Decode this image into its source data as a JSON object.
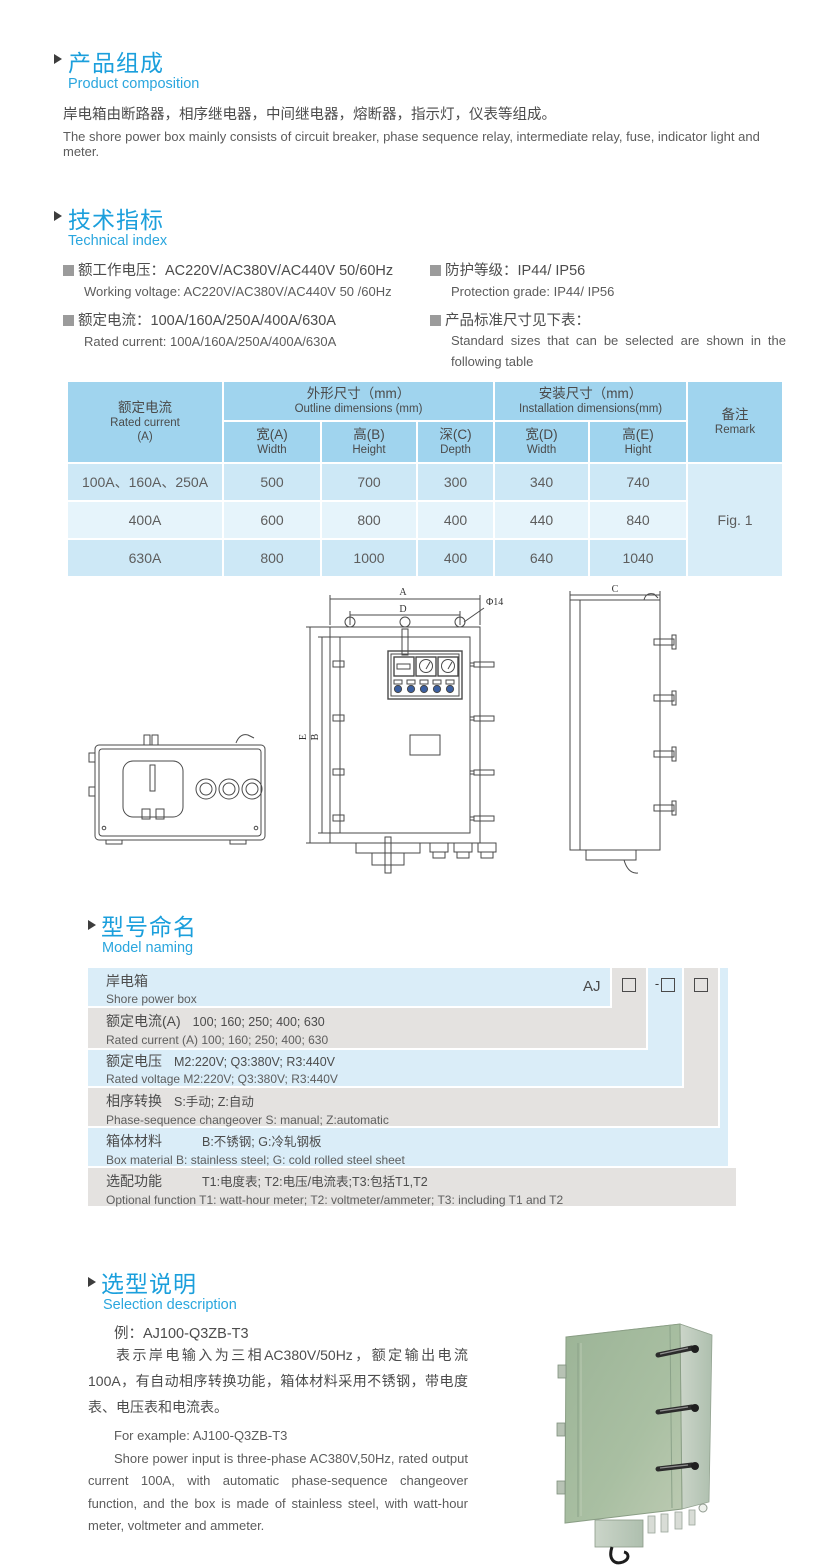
{
  "colors": {
    "accent_blue": "#1b9fdc",
    "subheading_blue": "#2aa6de",
    "table_header_bg": "#a0d4ee",
    "table_row_dark": "#cde8f6",
    "table_row_light": "#e6f4fb",
    "remark_cell_bg": "#d8edf8",
    "naming_blue": "#daedf8",
    "naming_gray": "#e4e2e0",
    "photo_green_front": "#a6bca0",
    "photo_green_side": "#c2cdc0"
  },
  "product_composition": {
    "title_cn": "产品组成",
    "title_en": "Product  composition",
    "body_cn": "岸电箱由断路器，相序继电器，中间继电器，熔断器，指示灯，仪表等组成。",
    "body_en": "The shore power box mainly consists of circuit breaker, phase sequence relay, intermediate relay, fuse, indicator light and meter."
  },
  "technical_index": {
    "title_cn": "技术指标",
    "title_en": "Technical index",
    "specs": [
      {
        "cn": "额工作电压：AC220V/AC380V/AC440V  50/60Hz",
        "en": "Working voltage: AC220V/AC380V/AC440V 50 /60Hz"
      },
      {
        "cn": "额定电流：100A/160A/250A/400A/630A",
        "en": "Rated current: 100A/160A/250A/400A/630A"
      },
      {
        "cn": "防护等级：IP44/ IP56",
        "en": "Protection grade: IP44/ IP56"
      },
      {
        "cn": "产品标准尺寸见下表：",
        "en": "Standard sizes that can be selected are shown in the following table"
      }
    ]
  },
  "size_table": {
    "header": {
      "current_cn": "额定电流",
      "current_en": "Rated current",
      "current_unit": "(A)",
      "outline_cn": "外形尺寸（mm）",
      "outline_en": "Outline dimensions (mm)",
      "install_cn": "安装尺寸（mm）",
      "install_en": "Installation dimensions(mm)",
      "remark_cn": "备注",
      "remark_en": "Remark",
      "sub": [
        {
          "cn": "宽(A)",
          "en": "Width"
        },
        {
          "cn": "高(B)",
          "en": "Height"
        },
        {
          "cn": "深(C)",
          "en": "Depth"
        },
        {
          "cn": "宽(D)",
          "en": "Width"
        },
        {
          "cn": "高(E)",
          "en": "Hight"
        }
      ]
    },
    "rows": [
      {
        "current": "100A、160A、250A",
        "w": "500",
        "h": "700",
        "d": "300",
        "iw": "340",
        "ih": "740"
      },
      {
        "current": "400A",
        "w": "600",
        "h": "800",
        "d": "400",
        "iw": "440",
        "ih": "840"
      },
      {
        "current": "630A",
        "w": "800",
        "h": "1000",
        "d": "400",
        "iw": "640",
        "ih": "1040"
      }
    ],
    "remark_value": "Fig. 1"
  },
  "drawing": {
    "dim_a": "A",
    "dim_b": "B",
    "dim_c": "C",
    "dim_d": "D",
    "dim_e": "E",
    "hole": "Φ14"
  },
  "model_naming": {
    "title_cn": "型号命名",
    "title_en": "Model naming",
    "code_prefix": "AJ",
    "code_separator": "-",
    "rows": [
      {
        "cn_label": "岸电箱",
        "cn_detail": "",
        "en": "Shore power box"
      },
      {
        "cn_label": "额定电流(A)",
        "cn_detail": "100; 160; 250; 400; 630",
        "en": "Rated current (A) 100; 160; 250; 400; 630"
      },
      {
        "cn_label": "额定电压",
        "cn_detail": "M2:220V;  Q3:380V;  R3:440V",
        "en": "Rated voltage  M2:220V;  Q3:380V;  R3:440V"
      },
      {
        "cn_label": "相序转换",
        "cn_detail": "S:手动; Z:自动",
        "en": "Phase-sequence changeover  S: manual;  Z:automatic"
      },
      {
        "cn_label": "箱体材料",
        "cn_detail": "B:不锈钢;  G:冷轧钢板",
        "en": "Box material   B: stainless steel; G: cold rolled steel sheet"
      },
      {
        "cn_label": "选配功能",
        "cn_detail": "T1:电度表;  T2:电压/电流表;T3:包括T1,T2",
        "en": "Optional function  T1: watt-hour meter; T2: voltmeter/ammeter; T3: including T1 and T2"
      }
    ]
  },
  "selection": {
    "title_cn": "选型说明",
    "title_en": "Selection description",
    "example_cn": "例：AJ100-Q3ZB-T3",
    "body_cn": "表示岸电输入为三相AC380V/50Hz，额定输出电流100A，有自动相序转换功能，箱体材料采用不锈钢，带电度表、电压表和电流表。",
    "example_en": "For example: AJ100-Q3ZB-T3",
    "body_en": "Shore power input is three-phase AC380V,50Hz, rated output current 100A, with automatic phase-sequence changeover function, and the box is made of stainless steel, with watt-hour meter, voltmeter and ammeter."
  }
}
